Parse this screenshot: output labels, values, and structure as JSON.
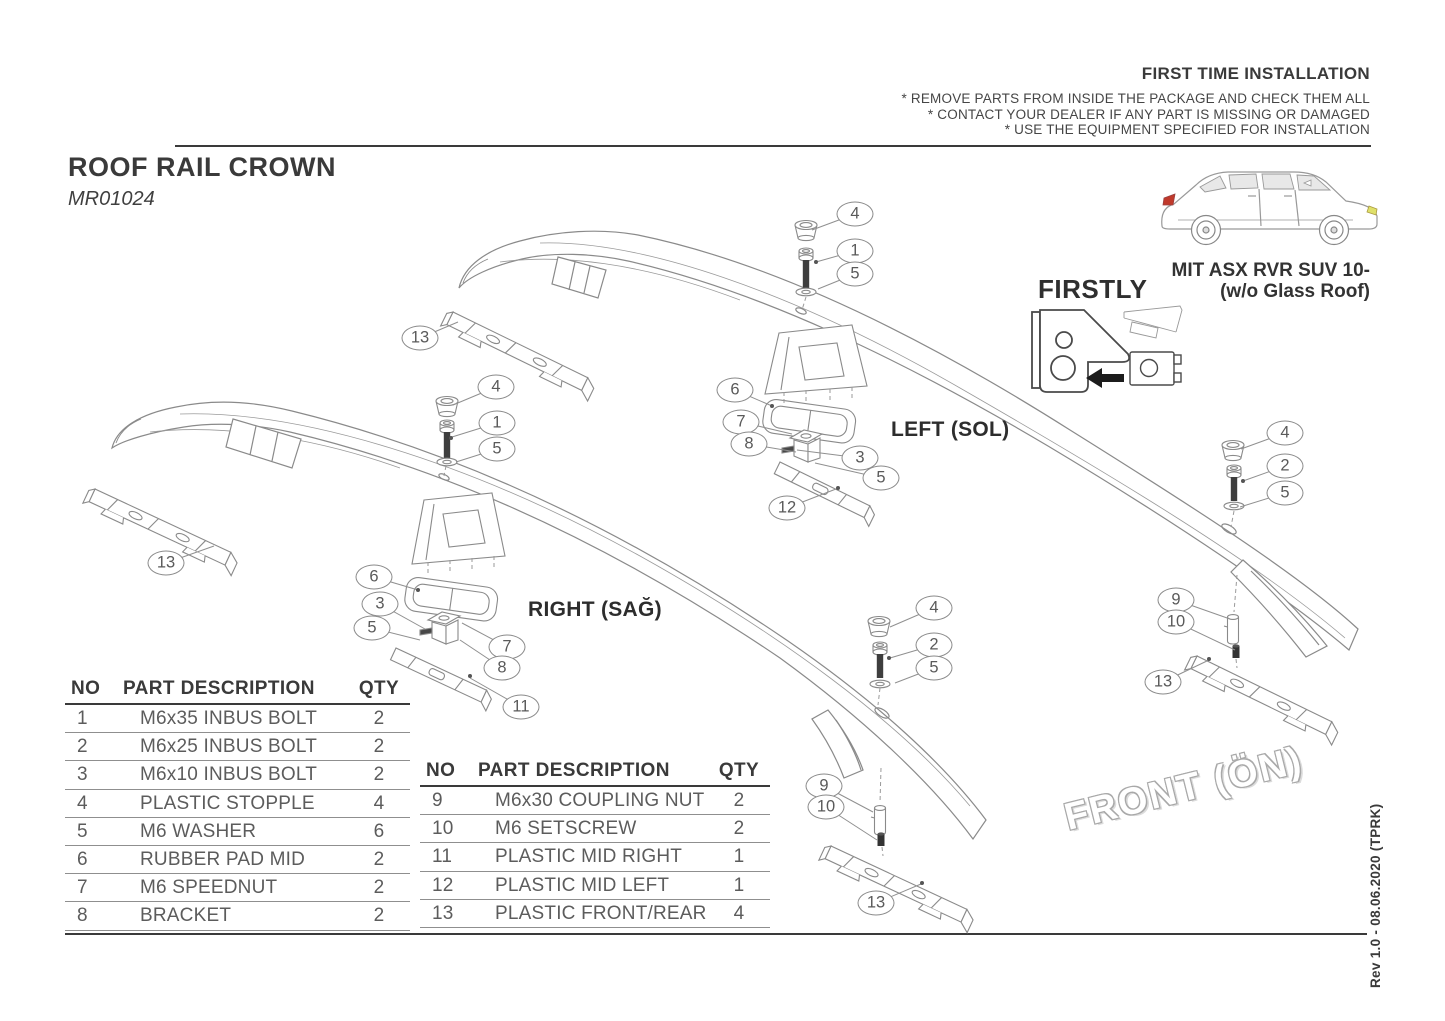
{
  "header": {
    "title": "FIRST TIME INSTALLATION",
    "notes": [
      "* REMOVE PARTS FROM INSIDE THE PACKAGE AND CHECK THEM ALL",
      "* CONTACT YOUR DEALER IF ANY PART IS MISSING OR DAMAGED",
      "* USE THE EQUIPMENT SPECIFIED FOR INSTALLATION"
    ]
  },
  "product": {
    "name": "ROOF RAIL CROWN",
    "code": "MR01024"
  },
  "vehicle": {
    "model": "MIT ASX RVR SUV 10-",
    "variant": "(w/o Glass Roof)"
  },
  "instructions": {
    "firstly": "FIRSTLY"
  },
  "diagram_labels": {
    "left": "LEFT (SOL)",
    "right": "RIGHT (SAĞ)",
    "front": "FRONT (ÖN)"
  },
  "revision": "Rev 1.0 - 08.06.2020 (TPRK)",
  "parts_tables": [
    {
      "headers": [
        "NO",
        "PART DESCRIPTION",
        "QTY"
      ],
      "rows": [
        {
          "no": "1",
          "desc": "M6x35 INBUS BOLT",
          "qty": "2"
        },
        {
          "no": "2",
          "desc": "M6x25 INBUS BOLT",
          "qty": "2"
        },
        {
          "no": "3",
          "desc": "M6x10 INBUS BOLT",
          "qty": "2"
        },
        {
          "no": "4",
          "desc": "PLASTIC STOPPLE",
          "qty": "4"
        },
        {
          "no": "5",
          "desc": "M6 WASHER",
          "qty": "6"
        },
        {
          "no": "6",
          "desc": "RUBBER PAD MID",
          "qty": "2"
        },
        {
          "no": "7",
          "desc": "M6 SPEEDNUT",
          "qty": "2"
        },
        {
          "no": "8",
          "desc": "BRACKET",
          "qty": "2"
        }
      ]
    },
    {
      "headers": [
        "NO",
        "PART DESCRIPTION",
        "QTY"
      ],
      "rows": [
        {
          "no": "9",
          "desc": "M6x30 COUPLING NUT",
          "qty": "2"
        },
        {
          "no": "10",
          "desc": "M6 SETSCREW",
          "qty": "2"
        },
        {
          "no": "11",
          "desc": "PLASTIC MID RIGHT",
          "qty": "1"
        },
        {
          "no": "12",
          "desc": "PLASTIC MID LEFT",
          "qty": "1"
        },
        {
          "no": "13",
          "desc": "PLASTIC FRONT/REAR",
          "qty": "4"
        }
      ]
    }
  ],
  "callouts": [
    {
      "label": "4",
      "x": 855,
      "y": 214
    },
    {
      "label": "1",
      "x": 855,
      "y": 251
    },
    {
      "label": "5",
      "x": 855,
      "y": 274
    },
    {
      "label": "13",
      "x": 420,
      "y": 338
    },
    {
      "label": "6",
      "x": 735,
      "y": 390
    },
    {
      "label": "7",
      "x": 741,
      "y": 422
    },
    {
      "label": "8",
      "x": 749,
      "y": 444
    },
    {
      "label": "3",
      "x": 860,
      "y": 458
    },
    {
      "label": "5",
      "x": 881,
      "y": 478
    },
    {
      "label": "12",
      "x": 787,
      "y": 508
    },
    {
      "label": "4",
      "x": 1285,
      "y": 433
    },
    {
      "label": "2",
      "x": 1285,
      "y": 466
    },
    {
      "label": "5",
      "x": 1285,
      "y": 493
    },
    {
      "label": "9",
      "x": 1176,
      "y": 600
    },
    {
      "label": "10",
      "x": 1176,
      "y": 622
    },
    {
      "label": "13",
      "x": 1163,
      "y": 682
    },
    {
      "label": "4",
      "x": 496,
      "y": 387
    },
    {
      "label": "1",
      "x": 497,
      "y": 423
    },
    {
      "label": "5",
      "x": 497,
      "y": 449
    },
    {
      "label": "13",
      "x": 166,
      "y": 563
    },
    {
      "label": "6",
      "x": 374,
      "y": 577
    },
    {
      "label": "3",
      "x": 380,
      "y": 604
    },
    {
      "label": "5",
      "x": 372,
      "y": 628
    },
    {
      "label": "7",
      "x": 507,
      "y": 647
    },
    {
      "label": "8",
      "x": 502,
      "y": 668
    },
    {
      "label": "11",
      "x": 521,
      "y": 707
    },
    {
      "label": "4",
      "x": 934,
      "y": 608
    },
    {
      "label": "2",
      "x": 934,
      "y": 645
    },
    {
      "label": "5",
      "x": 934,
      "y": 668
    },
    {
      "label": "9",
      "x": 824,
      "y": 786
    },
    {
      "label": "10",
      "x": 826,
      "y": 807
    },
    {
      "label": "13",
      "x": 876,
      "y": 903
    }
  ]
}
